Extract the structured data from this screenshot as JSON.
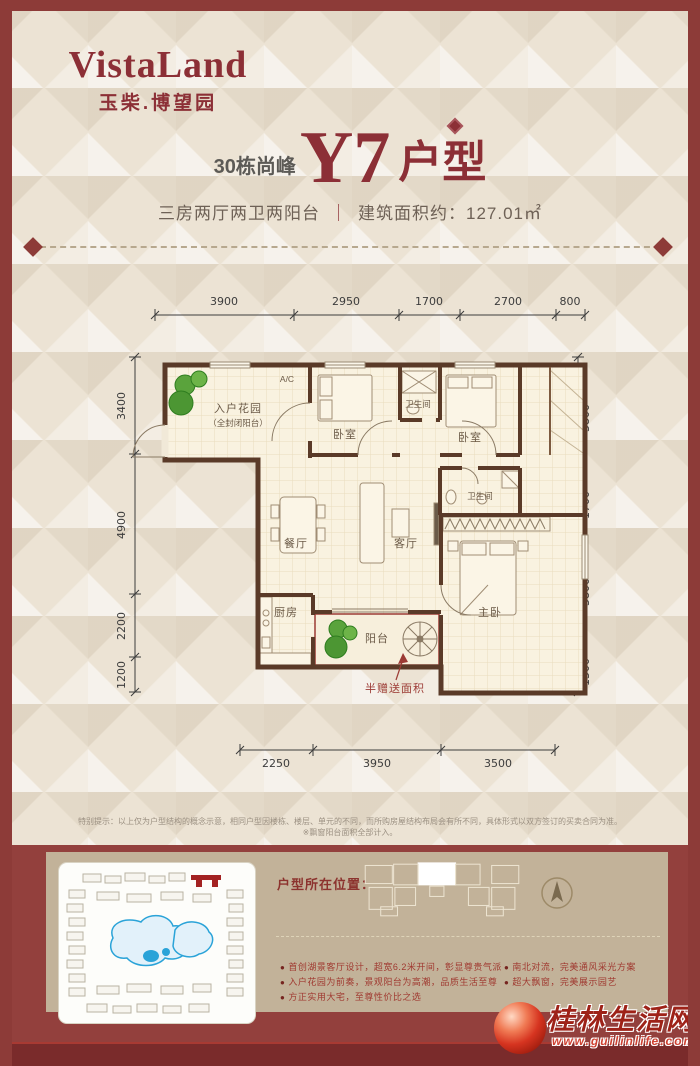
{
  "brand": {
    "logo_main": "VistaLand",
    "logo_sub": "玉柴.博望园"
  },
  "header": {
    "prefix": "30栋尚峰",
    "unit": "Y7",
    "suffix": "户型",
    "subtitle_left": "三房两厅两卫两阳台",
    "subtitle_divider": "｜",
    "subtitle_right": "建筑面积约：127.01㎡"
  },
  "floorplan": {
    "dims_top": [
      "3900",
      "2950",
      "1700",
      "2700",
      "800"
    ],
    "dims_left": [
      "3400",
      "4900",
      "2200",
      "1200"
    ],
    "dims_right": [
      "3800",
      "1700",
      "3800",
      "1300"
    ],
    "dims_bottom": [
      "2250",
      "3950",
      "3500"
    ],
    "labels": {
      "ac": "A/C",
      "entry_garden_1": "入户花园",
      "entry_garden_2": "（全封闭阳台）",
      "bedroom1": "卧室",
      "bath1": "卫生间",
      "bedroom2": "卧室",
      "bath2": "卫生间",
      "dining": "餐厅",
      "living": "客厅",
      "kitchen": "厨房",
      "balcony": "阳台",
      "master": "主卧",
      "gift": "半赠送面积"
    }
  },
  "disclaimer": {
    "line1": "特别提示：以上仅为户型结构的概念示意，相同户型因楼栋、楼层、单元的不同，而所购房屋结构布局会有所不同，具体形式以双方签订的买卖合同为准。",
    "line2": "※飘窗阳台面积全部计入。"
  },
  "footer": {
    "location_label": "户型所在位置：",
    "bullet_marker": "●",
    "bullets_left": [
      "首创湖景客厅设计，超宽6.2米开间，彰显尊贵气派",
      "入户花园为前奏，景观阳台为高潮，品质生活至尊",
      "方正实用大宅，至尊性价比之选"
    ],
    "bullets_right": [
      "南北对流，完美通风采光方案",
      "超大飘窗，完美展示园艺"
    ]
  },
  "watermark": {
    "name": "桂林生活网",
    "url": "www.guilinlife.com"
  }
}
